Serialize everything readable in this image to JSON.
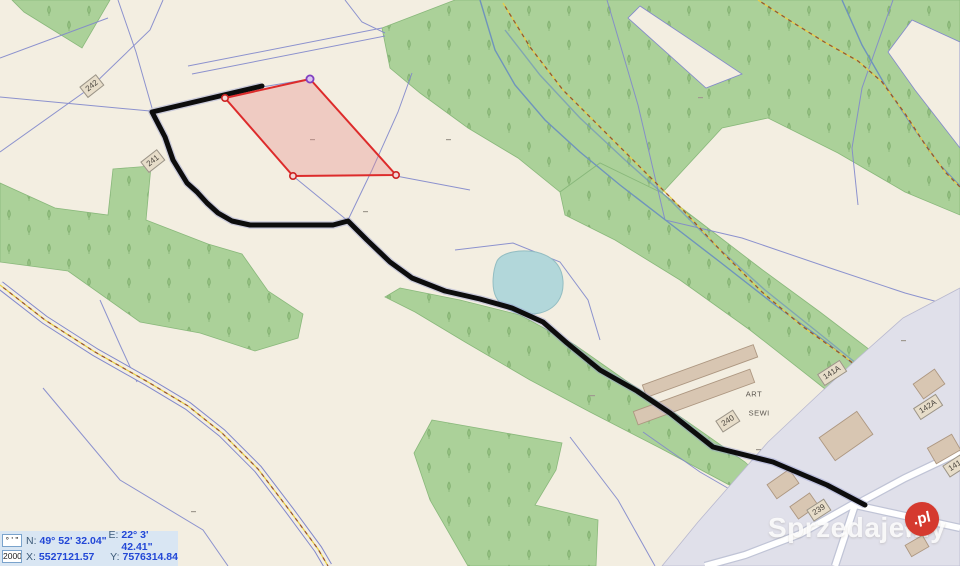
{
  "map": {
    "parcel_labels": [
      {
        "id": "242"
      },
      {
        "id": "241"
      },
      {
        "id": "240"
      },
      {
        "id": "239"
      },
      {
        "id": "141A"
      },
      {
        "id": "142A"
      },
      {
        "id": "141"
      }
    ],
    "place_label": {
      "line1": "ART",
      "line2": "SEWI"
    },
    "colors": {
      "selected_parcel_stroke": "#dd2b2b",
      "selected_parcel_vertex_top": "#8040c0",
      "route_line": "#0d0d0d",
      "forest_fill": "#abd199",
      "water_fill": "#b2d7da",
      "boundary_line": "#8188cc",
      "utility_dash_yellow": "#e6cf4a",
      "utility_dash_brown": "#9c5a28",
      "urban_fill": "#e0e0ea",
      "building_fill": "#d8c6b2",
      "background": "#f3eee1"
    }
  },
  "statusbar": {
    "format_value": "° ' \"",
    "scale_value": "2000",
    "n_label": "N:",
    "n_value": "49° 52' 32.04\"",
    "e_label": "E:",
    "e_value": "22° 3' 42.41\"",
    "x_label": "X:",
    "x_value": "5527121.57",
    "y_label": "Y:",
    "y_value": "7576314.84"
  },
  "watermark": {
    "text": "Sprzedajemy",
    "badge": ".pl"
  }
}
